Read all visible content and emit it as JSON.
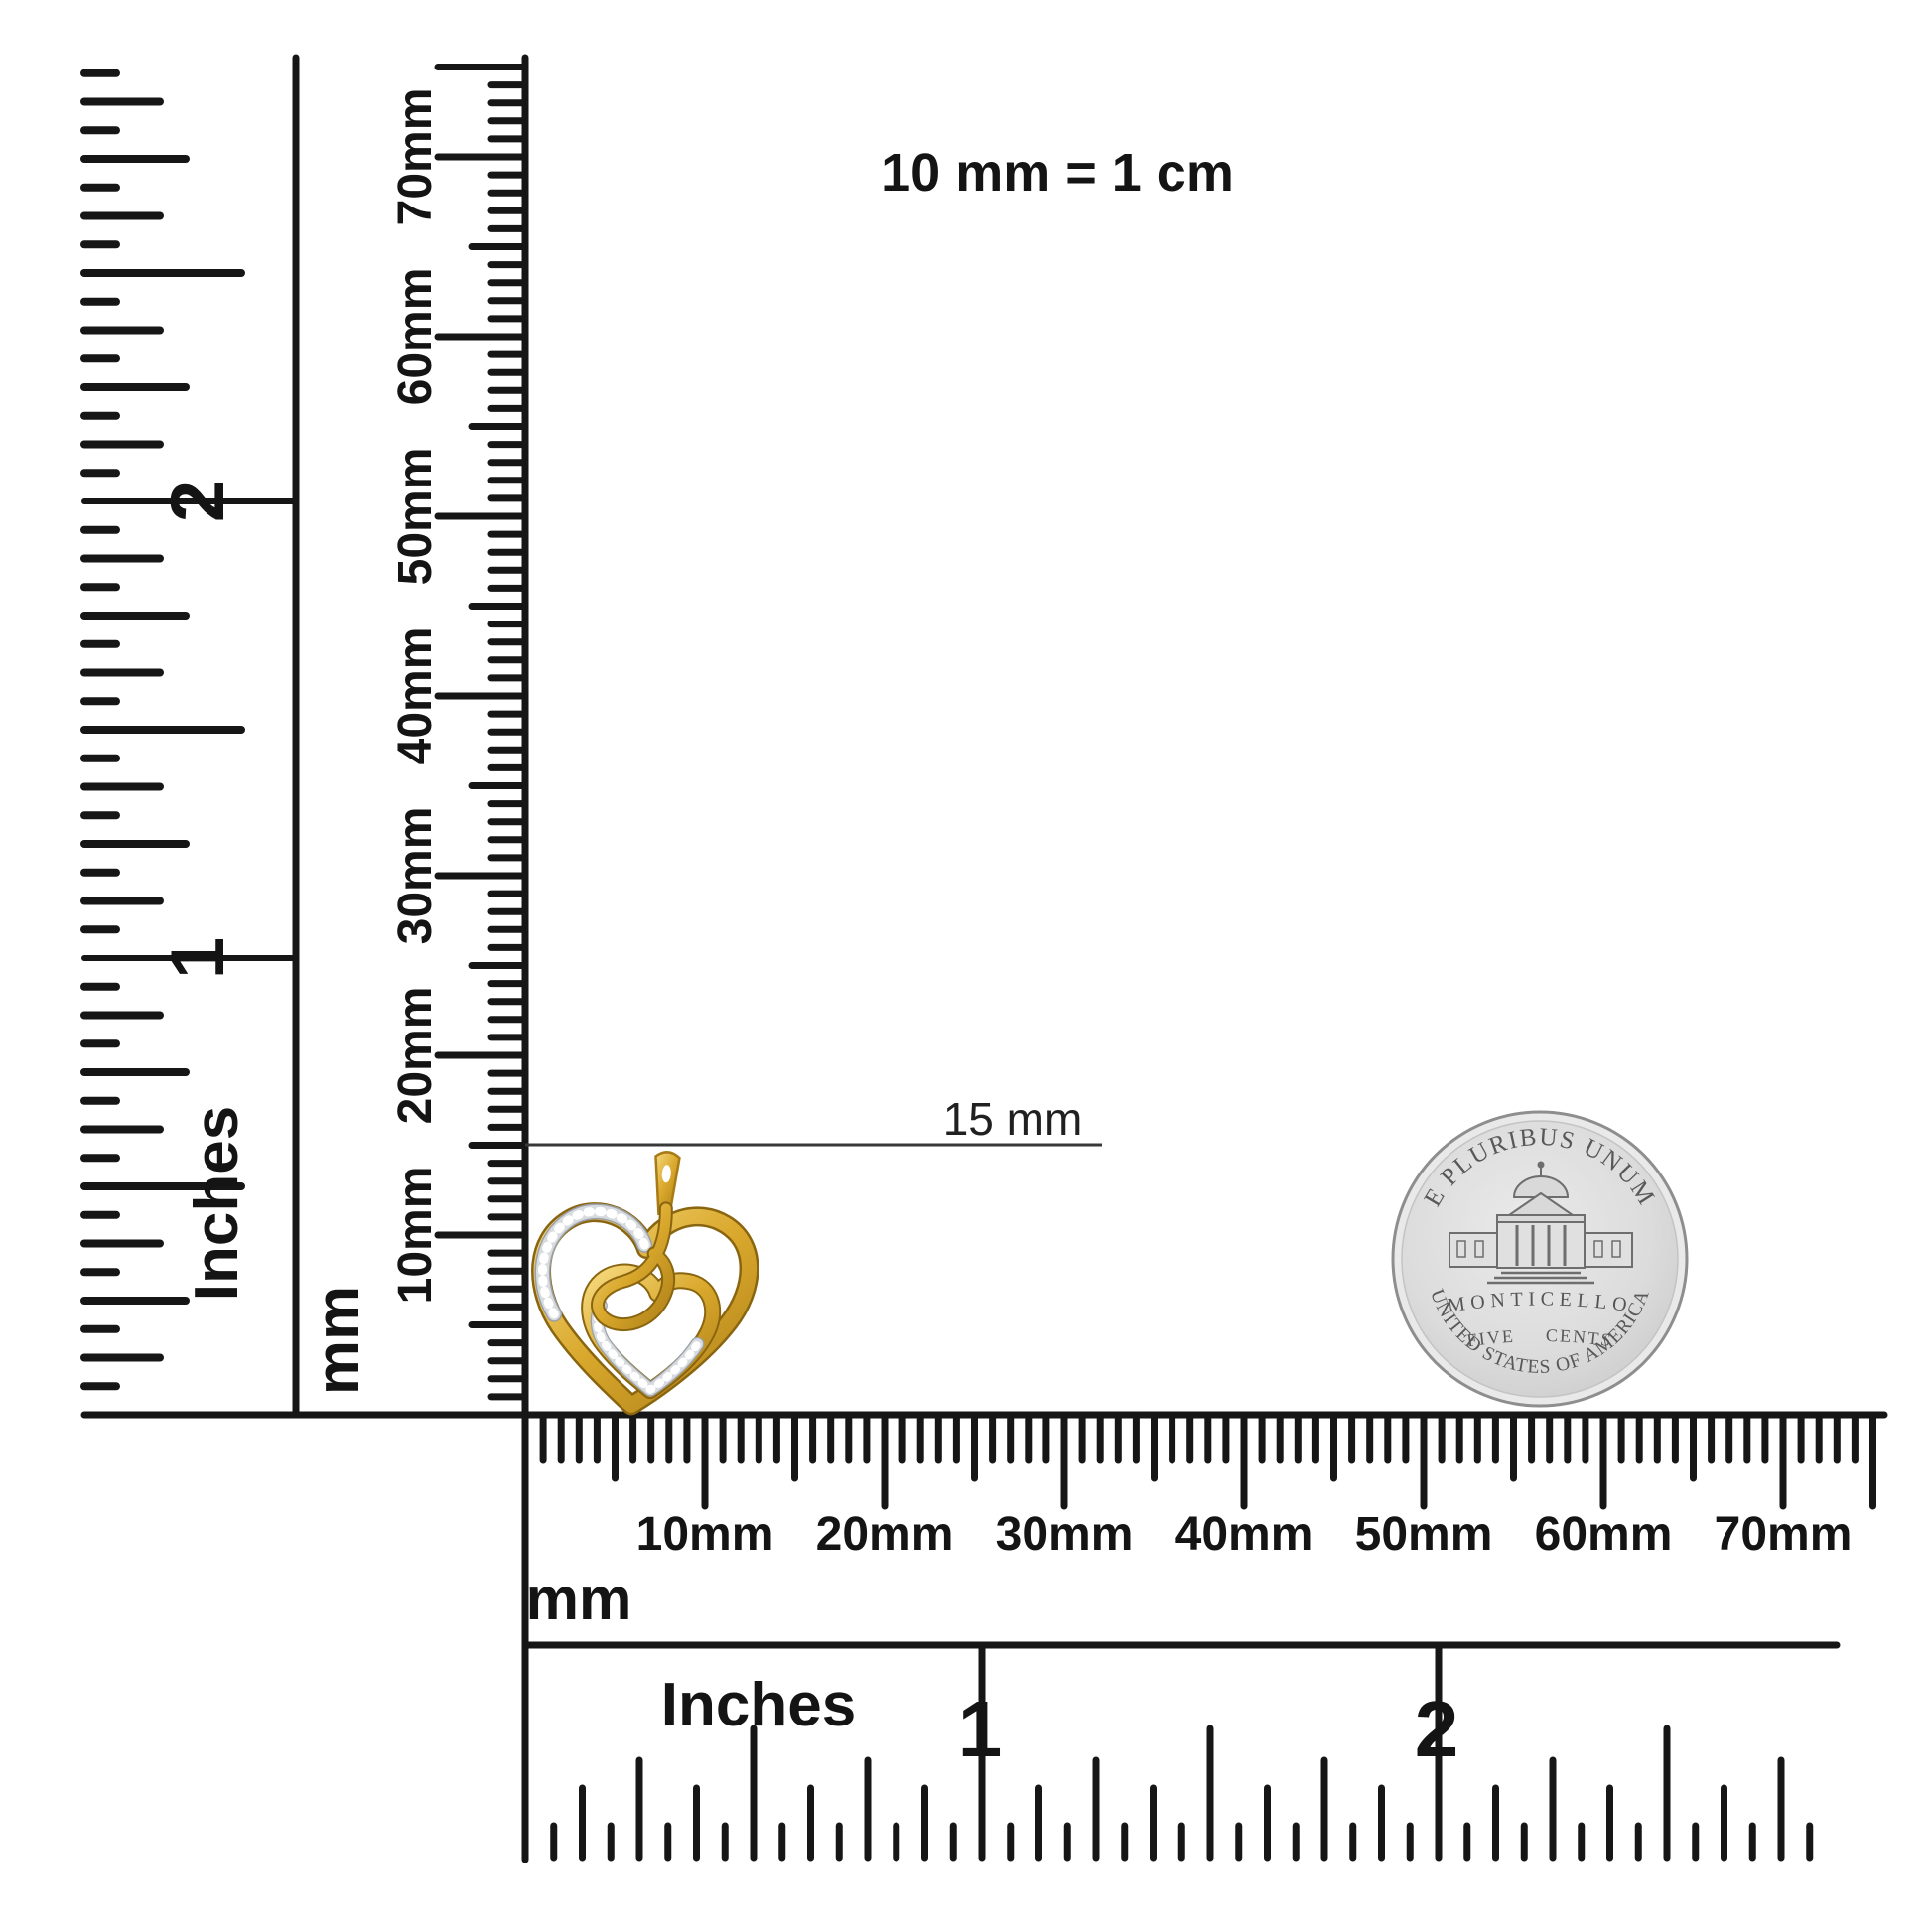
{
  "title_note": "10 mm = 1 cm",
  "measurement": {
    "label": "15 mm"
  },
  "left_inch_ruler": {
    "unit": "Inches",
    "numerals": [
      "1",
      "2"
    ]
  },
  "vertical_mm_ruler": {
    "unit": "mm",
    "labels": [
      "10mm",
      "20mm",
      "30mm",
      "40mm",
      "50mm",
      "60mm",
      "70mm"
    ]
  },
  "horizontal_mm_ruler": {
    "unit": "mm",
    "labels": [
      "10mm",
      "20mm",
      "30mm",
      "40mm",
      "50mm",
      "60mm",
      "70mm"
    ]
  },
  "bottom_inch_ruler": {
    "unit": "Inches",
    "numerals": [
      "1",
      "2"
    ]
  },
  "pendant": {
    "description": "gold heart pendant with diamond pave accents and center swirl",
    "colors": {
      "gold": "#D9A82C",
      "gold_dark": "#8A6510",
      "gold_light": "#F6D97E",
      "pave": "#D7DBDF",
      "pave_edge": "#9AA0A6",
      "sparkle": "#FFFFFF"
    }
  },
  "coin": {
    "top_inscription": "E PLURIBUS UNUM",
    "building_label": "MONTICELLO",
    "denomination": "FIVE CENTS",
    "bottom_inscription": "UNITED STATES OF AMERICA",
    "colors": {
      "field": "#DCDCDC",
      "rim": "#E9E9E9",
      "edge": "#8E8E8E",
      "engraving": "#585858"
    }
  },
  "ink": "#161616"
}
